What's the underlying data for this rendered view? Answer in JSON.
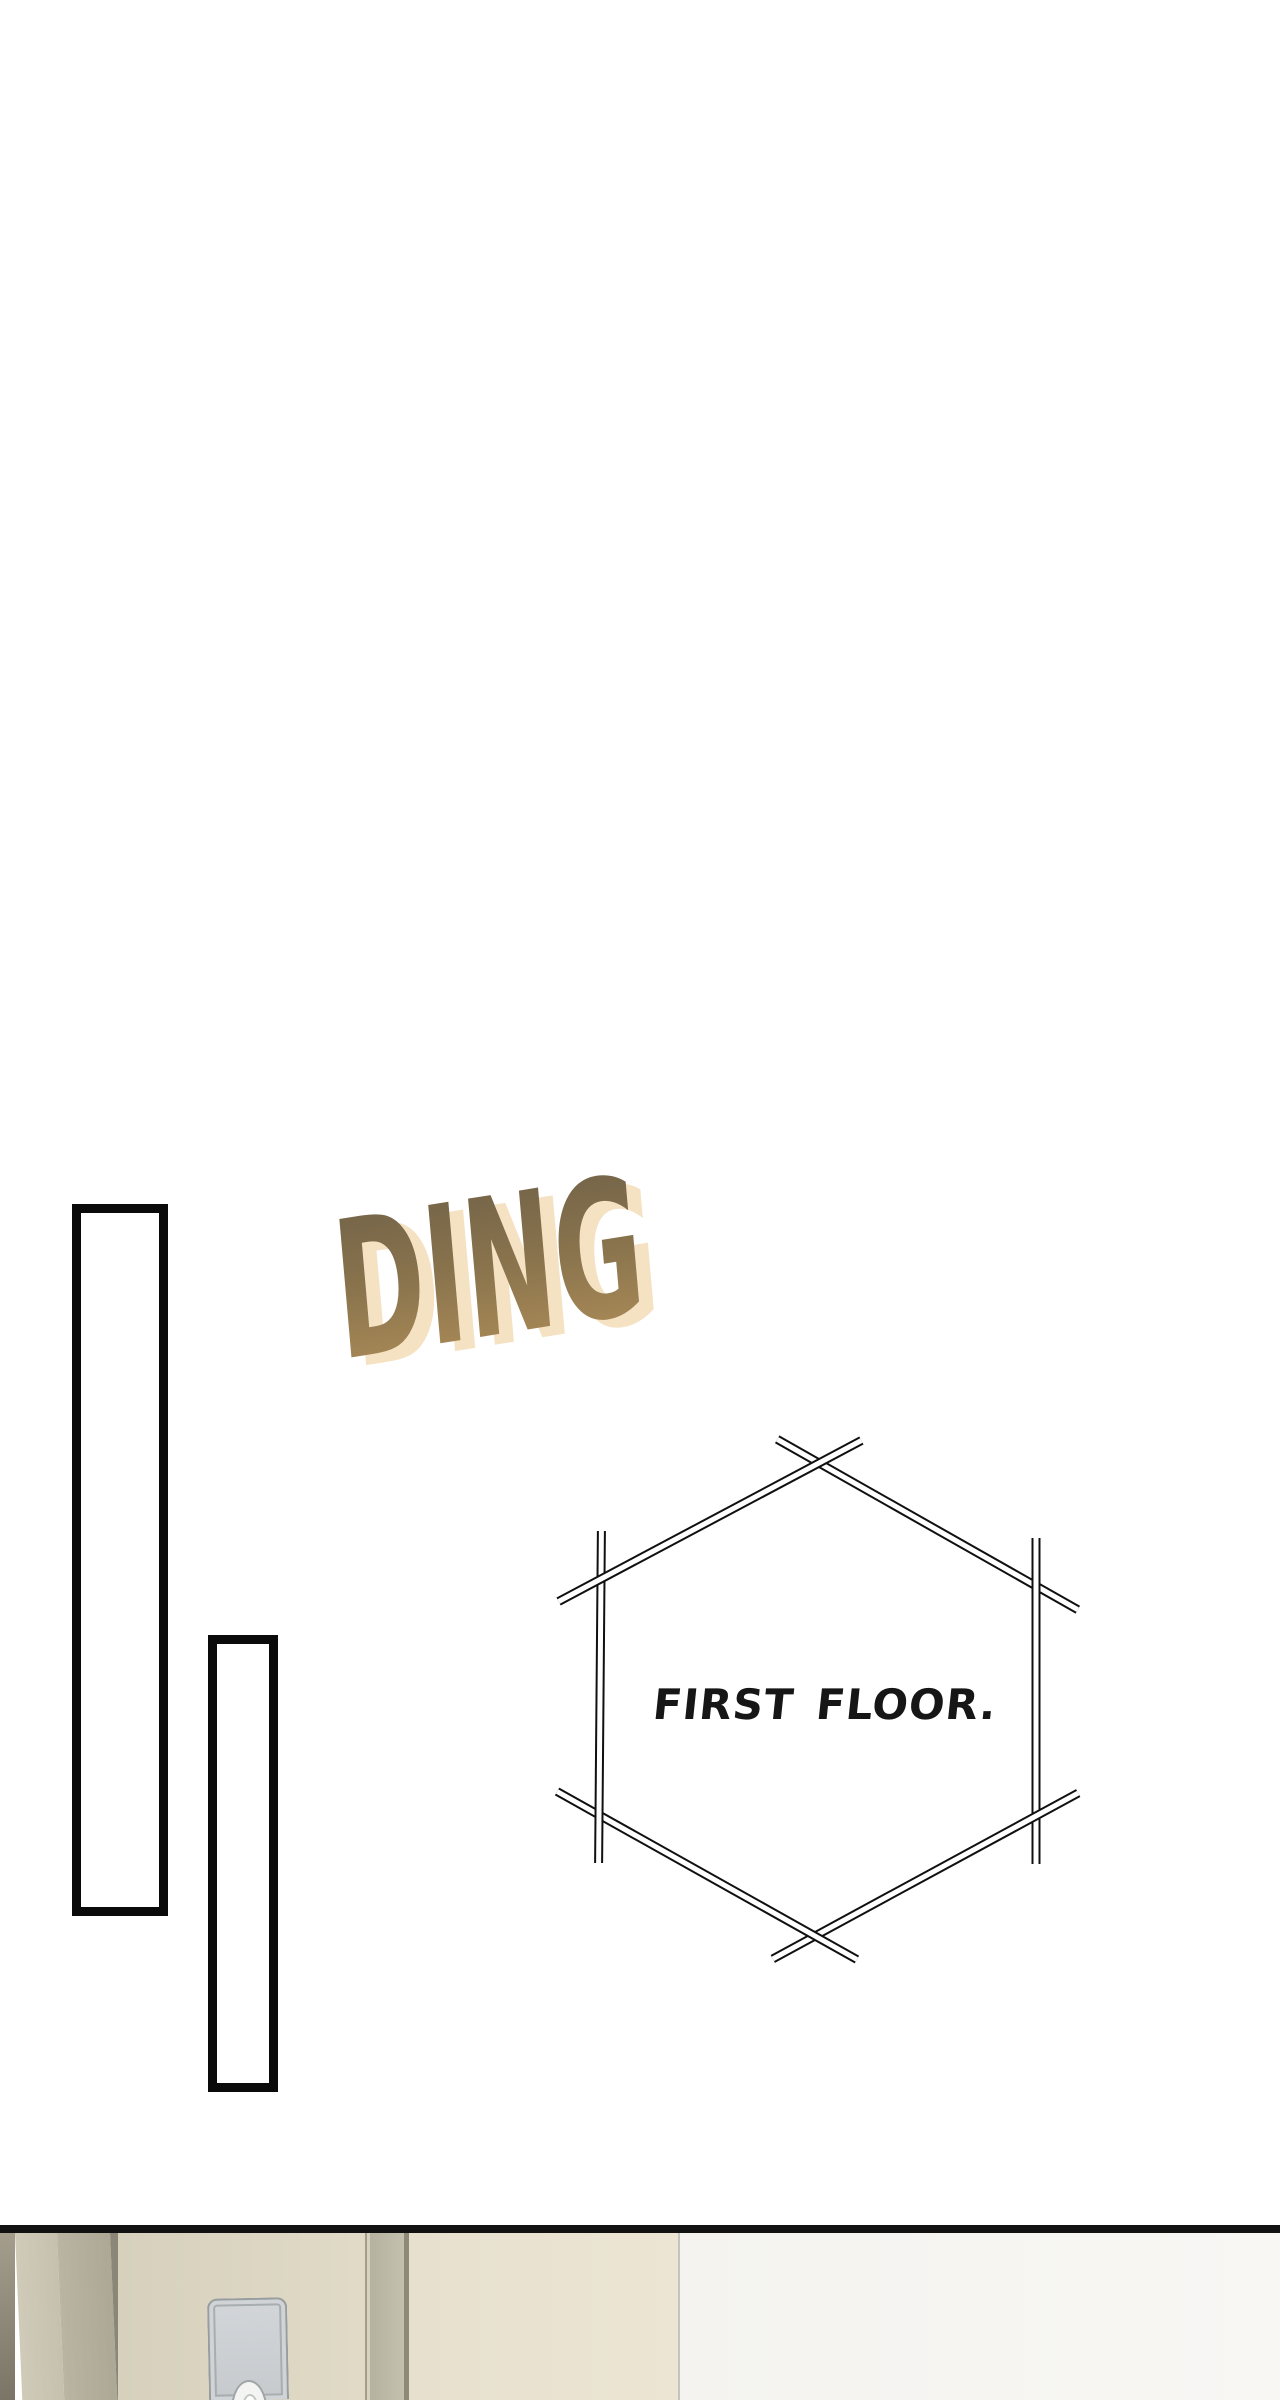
{
  "sfx": {
    "text": "DING",
    "gradient_top": "#6d5f47",
    "gradient_mid": "#8a744d",
    "gradient_bottom": "#b4915a",
    "shadow_color": "#f5e2c3"
  },
  "bubble": {
    "text": "FIRST FLOOR.",
    "outline_color": "#101010",
    "fill_color": "#ffffff",
    "text_color": "#161616"
  },
  "panels": {
    "rect_tall": {
      "border_color": "#0a0a0a",
      "fill": "#ffffff"
    },
    "rect_short": {
      "border_color": "#0a0a0a",
      "fill": "#ffffff"
    }
  },
  "bottom_scene": {
    "divider_color": "#121212",
    "wall_edge_color": "#8a8374",
    "frame_light_color": "#cbc5b3",
    "frame_dark_color": "#b3ad9b",
    "frame_edge_line_color": "#8c8678",
    "left_door_color": "#dcd6c3",
    "door_gap_colors": [
      "#a39d8c",
      "#bcb9a7",
      "#8e8a7a"
    ],
    "right_door_color": "#ebe4d2",
    "wall_line_color": "#c5c4be",
    "right_wall_color": "#f6f5f2",
    "lock_plate": {
      "face_color": "#cbcfd2",
      "border_color": "#989da0",
      "keyhole_color": "#f4f4f2"
    }
  }
}
